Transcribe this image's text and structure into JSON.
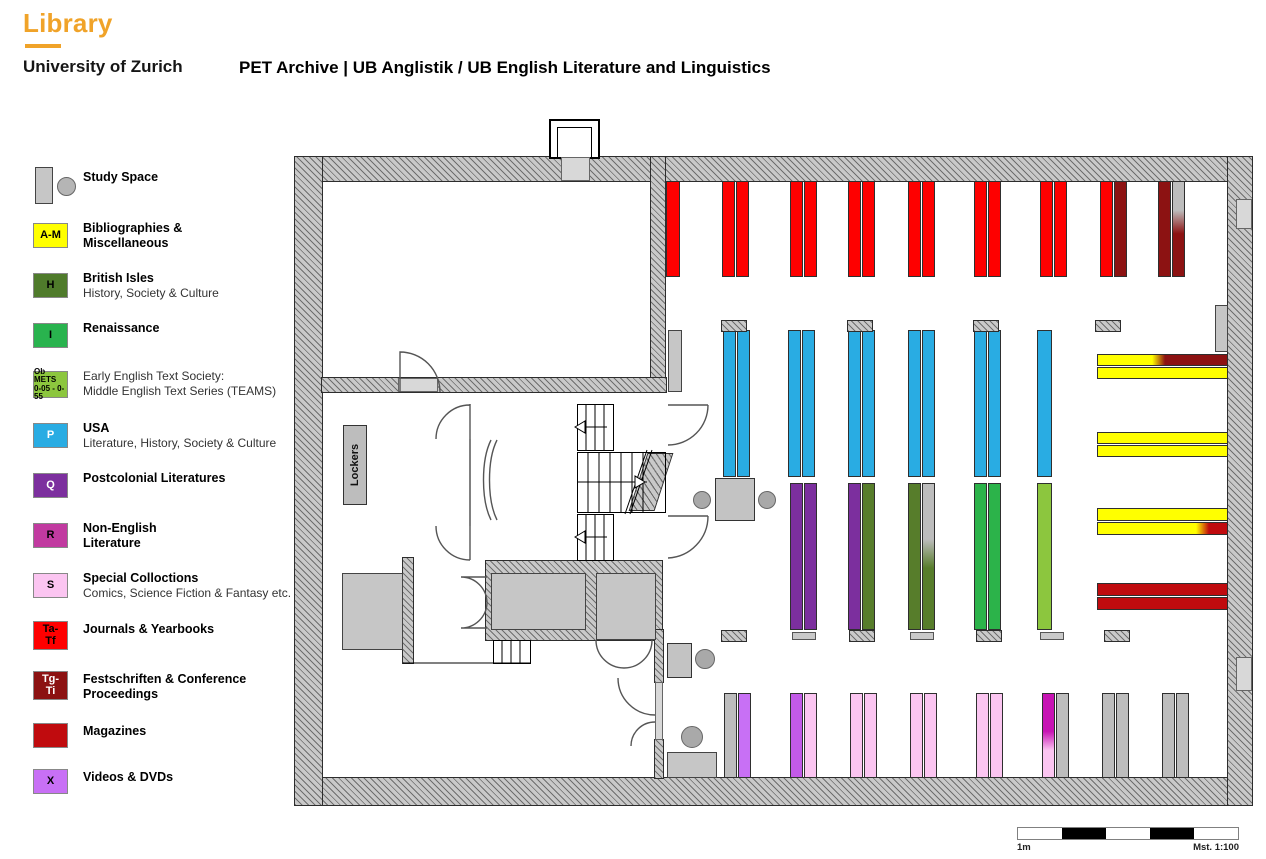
{
  "header": {
    "logo_title": "Library",
    "logo_subtitle": "University of Zurich",
    "page_title": "PET Archive | UB Anglistik / UB English Literature and Linguistics",
    "accent_color": "#F0A329"
  },
  "legend": {
    "items": [
      {
        "top": 167,
        "type": "study",
        "title": [
          "Study Space"
        ],
        "dy": 3
      },
      {
        "top": 223,
        "box": {
          "w": 35,
          "h": 25,
          "bg": "#FFFF00",
          "fg": "#000000",
          "lines": [
            "A-M"
          ],
          "fs": 11
        },
        "title": [
          "Bibliographies &",
          "Miscellaneous"
        ]
      },
      {
        "top": 273,
        "box": {
          "w": 35,
          "h": 25,
          "bg": "#4F7B2B",
          "fg": "#000000",
          "lines": [
            "H"
          ],
          "fs": 11
        },
        "title": [
          "British Isles"
        ],
        "sub": [
          "History, Society & Culture"
        ]
      },
      {
        "top": 323,
        "box": {
          "w": 35,
          "h": 25,
          "bg": "#29B34E",
          "fg": "#000000",
          "lines": [
            "I"
          ],
          "fs": 11
        },
        "title": [
          "Renaissance"
        ]
      },
      {
        "top": 371,
        "box": {
          "w": 35,
          "h": 27,
          "bg": "#8CC63E",
          "fg": "#000000",
          "lines": [
            "Ob METS",
            "0-05 - 0-55"
          ],
          "fs": 8
        },
        "sub": [
          "Early English Text Society:",
          "Middle English Text Series (TEAMS)"
        ]
      },
      {
        "top": 423,
        "box": {
          "w": 35,
          "h": 25,
          "bg": "#29ACE3",
          "fg": "#FFFFFF",
          "lines": [
            "P"
          ],
          "fs": 11
        },
        "title": [
          "USA"
        ],
        "sub": [
          "Literature, History, Society & Culture"
        ]
      },
      {
        "top": 473,
        "box": {
          "w": 35,
          "h": 25,
          "bg": "#7C2F9E",
          "fg": "#FFFFFF",
          "lines": [
            "Q"
          ],
          "fs": 11
        },
        "title": [
          "Postcolonial Literatures"
        ]
      },
      {
        "top": 523,
        "box": {
          "w": 35,
          "h": 25,
          "bg": "#C13AA0",
          "fg": "#000000",
          "lines": [
            "R"
          ],
          "fs": 11
        },
        "title": [
          "Non-English",
          "Literature"
        ]
      },
      {
        "top": 573,
        "box": {
          "w": 35,
          "h": 25,
          "bg": "#FBC5F1",
          "fg": "#000000",
          "lines": [
            "S"
          ],
          "fs": 11
        },
        "title": [
          "Special Colloctions"
        ],
        "sub": [
          "Comics, Science Fiction & Fantasy etc."
        ]
      },
      {
        "top": 621,
        "box": {
          "w": 35,
          "h": 29,
          "bg": "#FE0000",
          "fg": "#000000",
          "lines": [
            "Ta-",
            "Tf"
          ],
          "fs": 11
        },
        "title": [
          "Journals & Yearbooks"
        ],
        "dy": 1
      },
      {
        "top": 671,
        "box": {
          "w": 35,
          "h": 29,
          "bg": "#8C1212",
          "fg": "#FFFFFF",
          "lines": [
            "Tg-",
            "Ti"
          ],
          "fs": 11
        },
        "title": [
          "Festschriften & Conference",
          "Proceedings"
        ],
        "dy": 1
      },
      {
        "top": 723,
        "box": {
          "w": 35,
          "h": 25,
          "bg": "#C00B0E",
          "fg": "#000000",
          "lines": [],
          "fs": 11
        },
        "title": [
          "Magazines"
        ],
        "dy": 1
      },
      {
        "top": 769,
        "box": {
          "w": 35,
          "h": 25,
          "bg": "#C870F5",
          "fg": "#000000",
          "lines": [
            "X"
          ],
          "fs": 11
        },
        "title": [
          "Videos & DVDs"
        ],
        "dy": 1
      }
    ]
  },
  "floorplan": {
    "lockers_label": "Lockers",
    "palette": {
      "red": "#FE0000",
      "darkred": "#8C1212",
      "magred": "#C00B0E",
      "yellow": "#FFFF00",
      "blue": "#29ACE3",
      "purple": "#7C2F9E",
      "olive": "#577D2B",
      "green": "#2CB34A",
      "lightgreen": "#8CC63E",
      "pink": "#FBC5F1",
      "violet": "#C870F5",
      "violetmag": "#C25AE8",
      "magenta": "#C714B4",
      "grayshelf": "#BDBDBD",
      "grad_gray_darkred": {
        "dir": "v",
        "from": "#BDBDBD",
        "to": "#8C1212",
        "a": 30,
        "b": 55
      },
      "grad_gray_olive": {
        "dir": "v",
        "from": "#BDBDBD",
        "to": "#577D2B",
        "a": 38,
        "b": 58
      },
      "grad_magenta_pink": {
        "dir": "v",
        "from": "#C714B4",
        "to": "#FBC5F1",
        "a": 45,
        "b": 68
      },
      "grad_yellow_darkred": {
        "dir": "h",
        "from": "#FFFF00",
        "to": "#8C1212",
        "a": 42,
        "b": 52
      },
      "grad_yellow_magred": {
        "dir": "h",
        "from": "#FFFF00",
        "to": "#C00B0E",
        "a": 76,
        "b": 86
      }
    },
    "shelves": [
      {
        "x": 371,
        "y": 24,
        "w": 14,
        "h": 96,
        "fills": [
          "red"
        ]
      },
      {
        "x": 427,
        "y": 24,
        "w": 27,
        "h": 96,
        "fills": [
          "red",
          "red"
        ]
      },
      {
        "x": 495,
        "y": 24,
        "w": 27,
        "h": 96,
        "fills": [
          "red",
          "red"
        ]
      },
      {
        "x": 553,
        "y": 24,
        "w": 27,
        "h": 96,
        "fills": [
          "red",
          "red"
        ]
      },
      {
        "x": 613,
        "y": 24,
        "w": 27,
        "h": 96,
        "fills": [
          "red",
          "red"
        ]
      },
      {
        "x": 679,
        "y": 24,
        "w": 27,
        "h": 96,
        "fills": [
          "red",
          "red"
        ]
      },
      {
        "x": 745,
        "y": 24,
        "w": 27,
        "h": 96,
        "fills": [
          "red",
          "red"
        ]
      },
      {
        "x": 805,
        "y": 24,
        "w": 27,
        "h": 96,
        "fills": [
          "red",
          "darkred"
        ]
      },
      {
        "x": 863,
        "y": 24,
        "w": 27,
        "h": 96,
        "fills": [
          "darkred",
          "grad_gray_darkred"
        ]
      },
      {
        "x": 428,
        "y": 173,
        "w": 27,
        "h": 147,
        "fills": [
          "blue",
          "blue"
        ]
      },
      {
        "x": 493,
        "y": 173,
        "w": 27,
        "h": 147,
        "fills": [
          "blue",
          "blue"
        ]
      },
      {
        "x": 553,
        "y": 173,
        "w": 27,
        "h": 147,
        "fills": [
          "blue",
          "blue"
        ]
      },
      {
        "x": 613,
        "y": 173,
        "w": 27,
        "h": 147,
        "fills": [
          "blue",
          "blue"
        ]
      },
      {
        "x": 679,
        "y": 173,
        "w": 27,
        "h": 147,
        "fills": [
          "blue",
          "blue"
        ]
      },
      {
        "x": 742,
        "y": 173,
        "w": 15,
        "h": 147,
        "fills": [
          "blue"
        ]
      },
      {
        "x": 495,
        "y": 326,
        "w": 27,
        "h": 147,
        "fills": [
          "purple",
          "purple"
        ]
      },
      {
        "x": 553,
        "y": 326,
        "w": 27,
        "h": 147,
        "fills": [
          "purple",
          "olive"
        ]
      },
      {
        "x": 613,
        "y": 326,
        "w": 27,
        "h": 147,
        "fills": [
          "olive",
          "grad_gray_olive"
        ]
      },
      {
        "x": 679,
        "y": 326,
        "w": 27,
        "h": 147,
        "fills": [
          "green",
          "green"
        ]
      },
      {
        "x": 742,
        "y": 326,
        "w": 15,
        "h": 147,
        "fills": [
          "lightgreen"
        ]
      },
      {
        "x": 429,
        "y": 536,
        "w": 27,
        "h": 85,
        "fills": [
          "grayshelf",
          "violet"
        ]
      },
      {
        "x": 495,
        "y": 536,
        "w": 27,
        "h": 85,
        "fills": [
          "violetmag",
          "pink"
        ]
      },
      {
        "x": 555,
        "y": 536,
        "w": 27,
        "h": 85,
        "fills": [
          "pink",
          "pink"
        ]
      },
      {
        "x": 615,
        "y": 536,
        "w": 27,
        "h": 85,
        "fills": [
          "pink",
          "pink"
        ]
      },
      {
        "x": 681,
        "y": 536,
        "w": 27,
        "h": 85,
        "fills": [
          "pink",
          "pink"
        ]
      },
      {
        "x": 747,
        "y": 536,
        "w": 27,
        "h": 85,
        "fills": [
          "grad_magenta_pink",
          "grayshelf"
        ]
      },
      {
        "x": 807,
        "y": 536,
        "w": 27,
        "h": 85,
        "fills": [
          "grayshelf",
          "grayshelf"
        ]
      },
      {
        "x": 867,
        "y": 536,
        "w": 27,
        "h": 85,
        "fills": [
          "grayshelf",
          "grayshelf"
        ]
      }
    ],
    "hbars": [
      {
        "x": 802,
        "y": 197,
        "w": 131,
        "h": 12,
        "fill": "grad_yellow_darkred"
      },
      {
        "x": 802,
        "y": 210,
        "w": 131,
        "h": 12,
        "fill": "yellow"
      },
      {
        "x": 802,
        "y": 275,
        "w": 131,
        "h": 12,
        "fill": "yellow"
      },
      {
        "x": 802,
        "y": 288,
        "w": 131,
        "h": 12,
        "fill": "yellow"
      },
      {
        "x": 802,
        "y": 351,
        "w": 131,
        "h": 13,
        "fill": "yellow"
      },
      {
        "x": 802,
        "y": 365,
        "w": 131,
        "h": 13,
        "fill": "grad_yellow_magred"
      },
      {
        "x": 802,
        "y": 426,
        "w": 131,
        "h": 13,
        "fill": "magred"
      },
      {
        "x": 802,
        "y": 440,
        "w": 131,
        "h": 13,
        "fill": "magred"
      }
    ],
    "caps_hatch": [
      [
        427,
        164
      ],
      [
        553,
        164
      ],
      [
        679,
        164
      ],
      [
        801,
        164
      ],
      [
        427,
        474
      ],
      [
        555,
        474
      ],
      [
        682,
        474
      ],
      [
        810,
        474
      ]
    ],
    "caps_gray": [
      [
        497,
        475
      ],
      [
        615,
        475
      ],
      [
        745,
        475
      ]
    ],
    "tables": [
      [
        420,
        321,
        40,
        43
      ],
      [
        372,
        486,
        25,
        35
      ]
    ],
    "chairs": [
      [
        398,
        334,
        18
      ],
      [
        463,
        334,
        18
      ],
      [
        400,
        492,
        20
      ],
      [
        386,
        569,
        22
      ]
    ],
    "gray_blocks": [
      [
        372,
        595,
        50,
        26
      ],
      [
        47,
        416,
        61,
        77
      ],
      [
        196,
        416,
        95,
        57
      ],
      [
        301,
        416,
        60,
        67
      ],
      [
        373,
        173,
        14,
        62
      ],
      [
        920,
        148,
        13,
        47
      ]
    ],
    "niches": [
      [
        941,
        42,
        16,
        30
      ],
      [
        941,
        500,
        16,
        34
      ]
    ]
  },
  "scalebar": {
    "left_label": "1m",
    "right_label": "Mst. 1:100",
    "segments": 5
  }
}
